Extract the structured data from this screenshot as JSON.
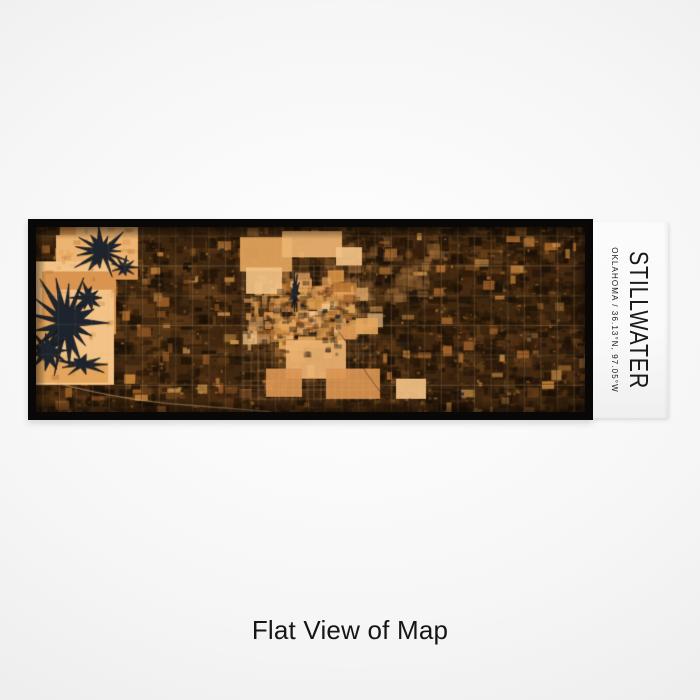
{
  "print": {
    "title": "STILLWATER",
    "subtitle": "OKLAHOMA / 36.13°N, 97.05°W",
    "caption": "Flat View of Map"
  },
  "location": {
    "city": "STILLWATER",
    "state": "OKLAHOMA",
    "coordinates": "36.13°N, 97.05°W"
  },
  "theme": {
    "text": "#1a1a1a",
    "caption": "#161616",
    "frame": "#0a0807",
    "label_bg": "#fafafa",
    "page_bg_center": "#ffffff",
    "page_bg_edge": "#e2e2e2"
  },
  "map": {
    "type": "map",
    "colors": {
      "base": "#40270f",
      "mottle_dark": [
        "#170e06",
        "#241507",
        "#2e1b0a",
        "#1d1207"
      ],
      "mottle_mid": [
        "#4a2c11",
        "#5a3615",
        "#65401a",
        "#3a2410"
      ],
      "field": [
        "#b5712f",
        "#c9873c",
        "#a5622a",
        "#d59a4e"
      ],
      "bright": [
        "#e3a55c",
        "#edb371",
        "#f2c286",
        "#d99450"
      ],
      "tan": "#9a6a38",
      "water": "#1e242e",
      "water_edge": "#10141b",
      "grid_light": "rgba(226,180,124,0.18)",
      "grid_dark": "rgba(12,7,3,0.40)",
      "street": "rgba(230,185,130,0.22)",
      "road_curve": "rgba(225,180,125,0.50)"
    }
  }
}
